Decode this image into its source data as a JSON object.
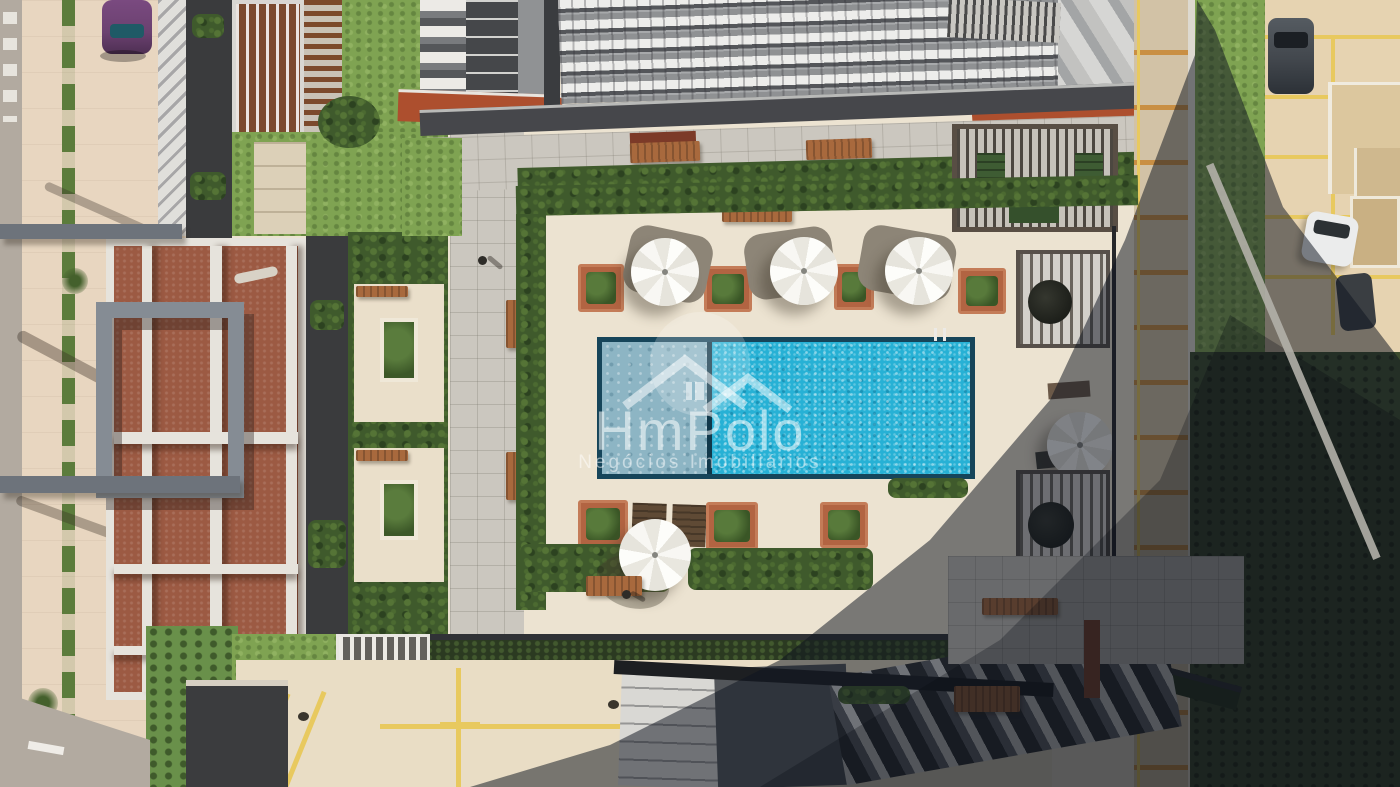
{
  "watermark": {
    "brand": "HmPolo",
    "tagline": "Negócios Imobiliários",
    "logo_icon": "double-roof-house-icon"
  },
  "scene": {
    "setting": "aerial top-down drone photo of a residential condominium pool courtyard",
    "lighting": "hard daylight with a large diagonal high-rise shadow across the right side",
    "umbrella_count": 5,
    "features": [
      "rectangular swimming pool with shallow lane and divider",
      "white hexagonal patio umbrellas",
      "brick planters with tropical plants",
      "wooden benches and sun loungers",
      "slatted pergolas with tables",
      "terracotta roof building with white beams",
      "high-rise balcony floors at top",
      "street and parking lots with yellow and orange markings",
      "parked cars: purple, dark gray, white",
      "hedges, lawns and palm trees"
    ]
  },
  "colors": {
    "deck": "#ece3d1",
    "paver": "#cbc7bf",
    "sidewalk": "#e8d6c0",
    "road": "#b2aaa0",
    "hedge": "#3f5a2c",
    "grass": "#7fa352",
    "grass_dark": "#516e36",
    "terracotta": "#9c5a43",
    "brick": "#ad4f2e",
    "planter_brick": "#b26442",
    "beam_white": "#e6e3dc",
    "charcoal": "#3a3b3d",
    "facade": "#909294",
    "pool": "#27b1d5",
    "pool_shallow": "#8db5c4",
    "pool_edge": "#16455a",
    "umbrella": "#f6f5f1",
    "wood": "#a8693d",
    "yellow_line": "#e8c95f",
    "orange_line": "#c98f44",
    "taupe_pad": "#8d8577",
    "shadow": "rgba(16,22,32,0.52)",
    "watermark": "rgba(255,255,255,0.55)",
    "car_purple": "#6b4170",
    "car_dark": "#42474d",
    "car_white": "#ebecec"
  }
}
